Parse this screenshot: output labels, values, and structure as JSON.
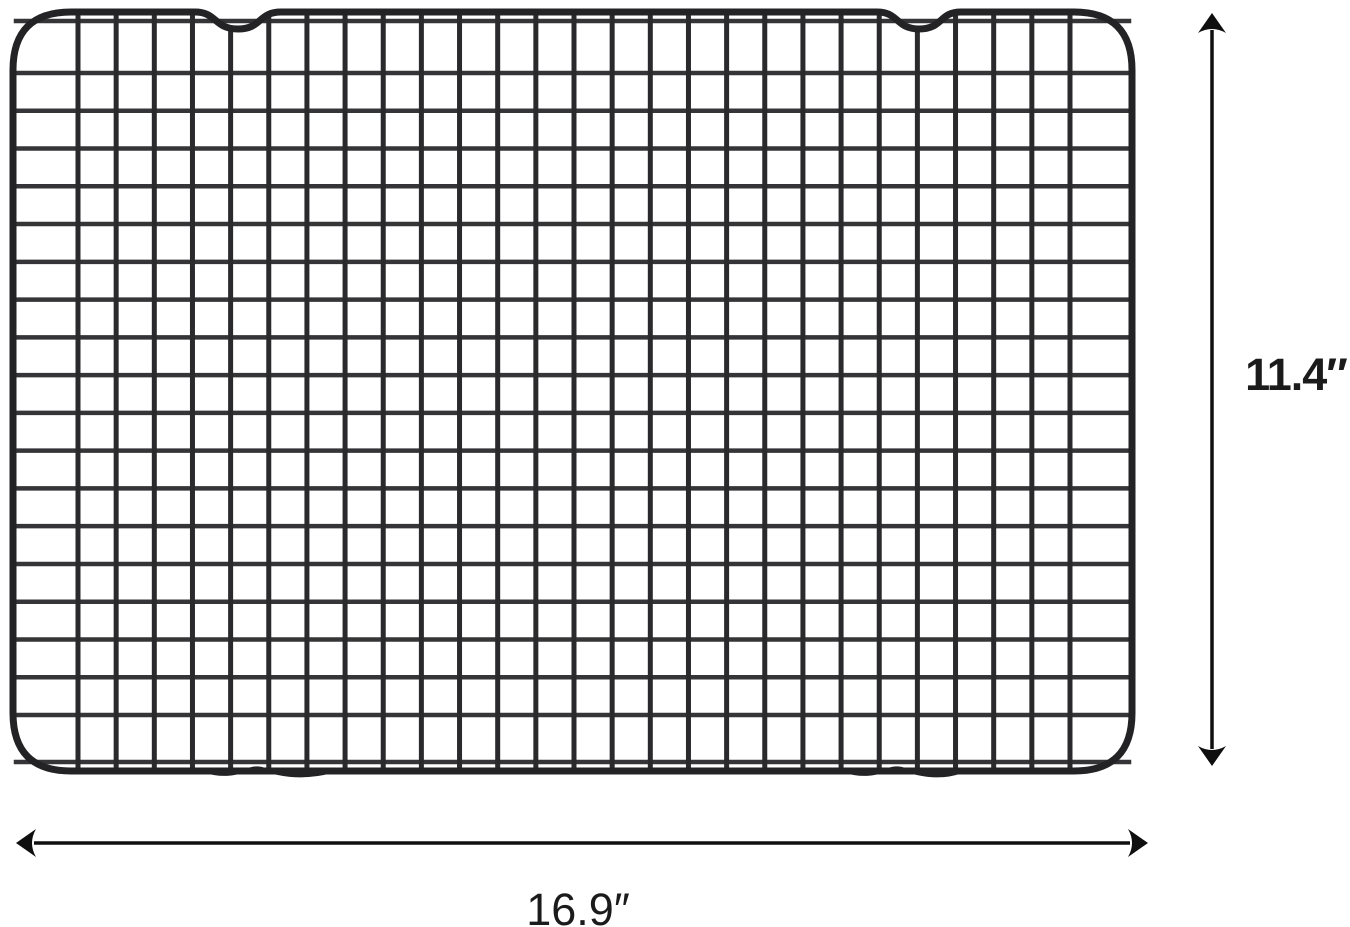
{
  "figure": {
    "type": "product-dimension-diagram",
    "subject": "black wire cooling rack with grid mesh, two top notches and bottom feet",
    "background_color": "#ffffff"
  },
  "rack": {
    "frame_color": "#232325",
    "wire_color": "#2a2a2c",
    "cross_wire_color": "#353537",
    "grid_columns": 28,
    "grid_rows": 20,
    "top_notches": 2
  },
  "dimensions": {
    "height": {
      "label": "11.4″"
    },
    "width": {
      "label": "16.9″"
    },
    "arrow_color": "#0f0f0f",
    "label_color": "#1b1b1b"
  }
}
